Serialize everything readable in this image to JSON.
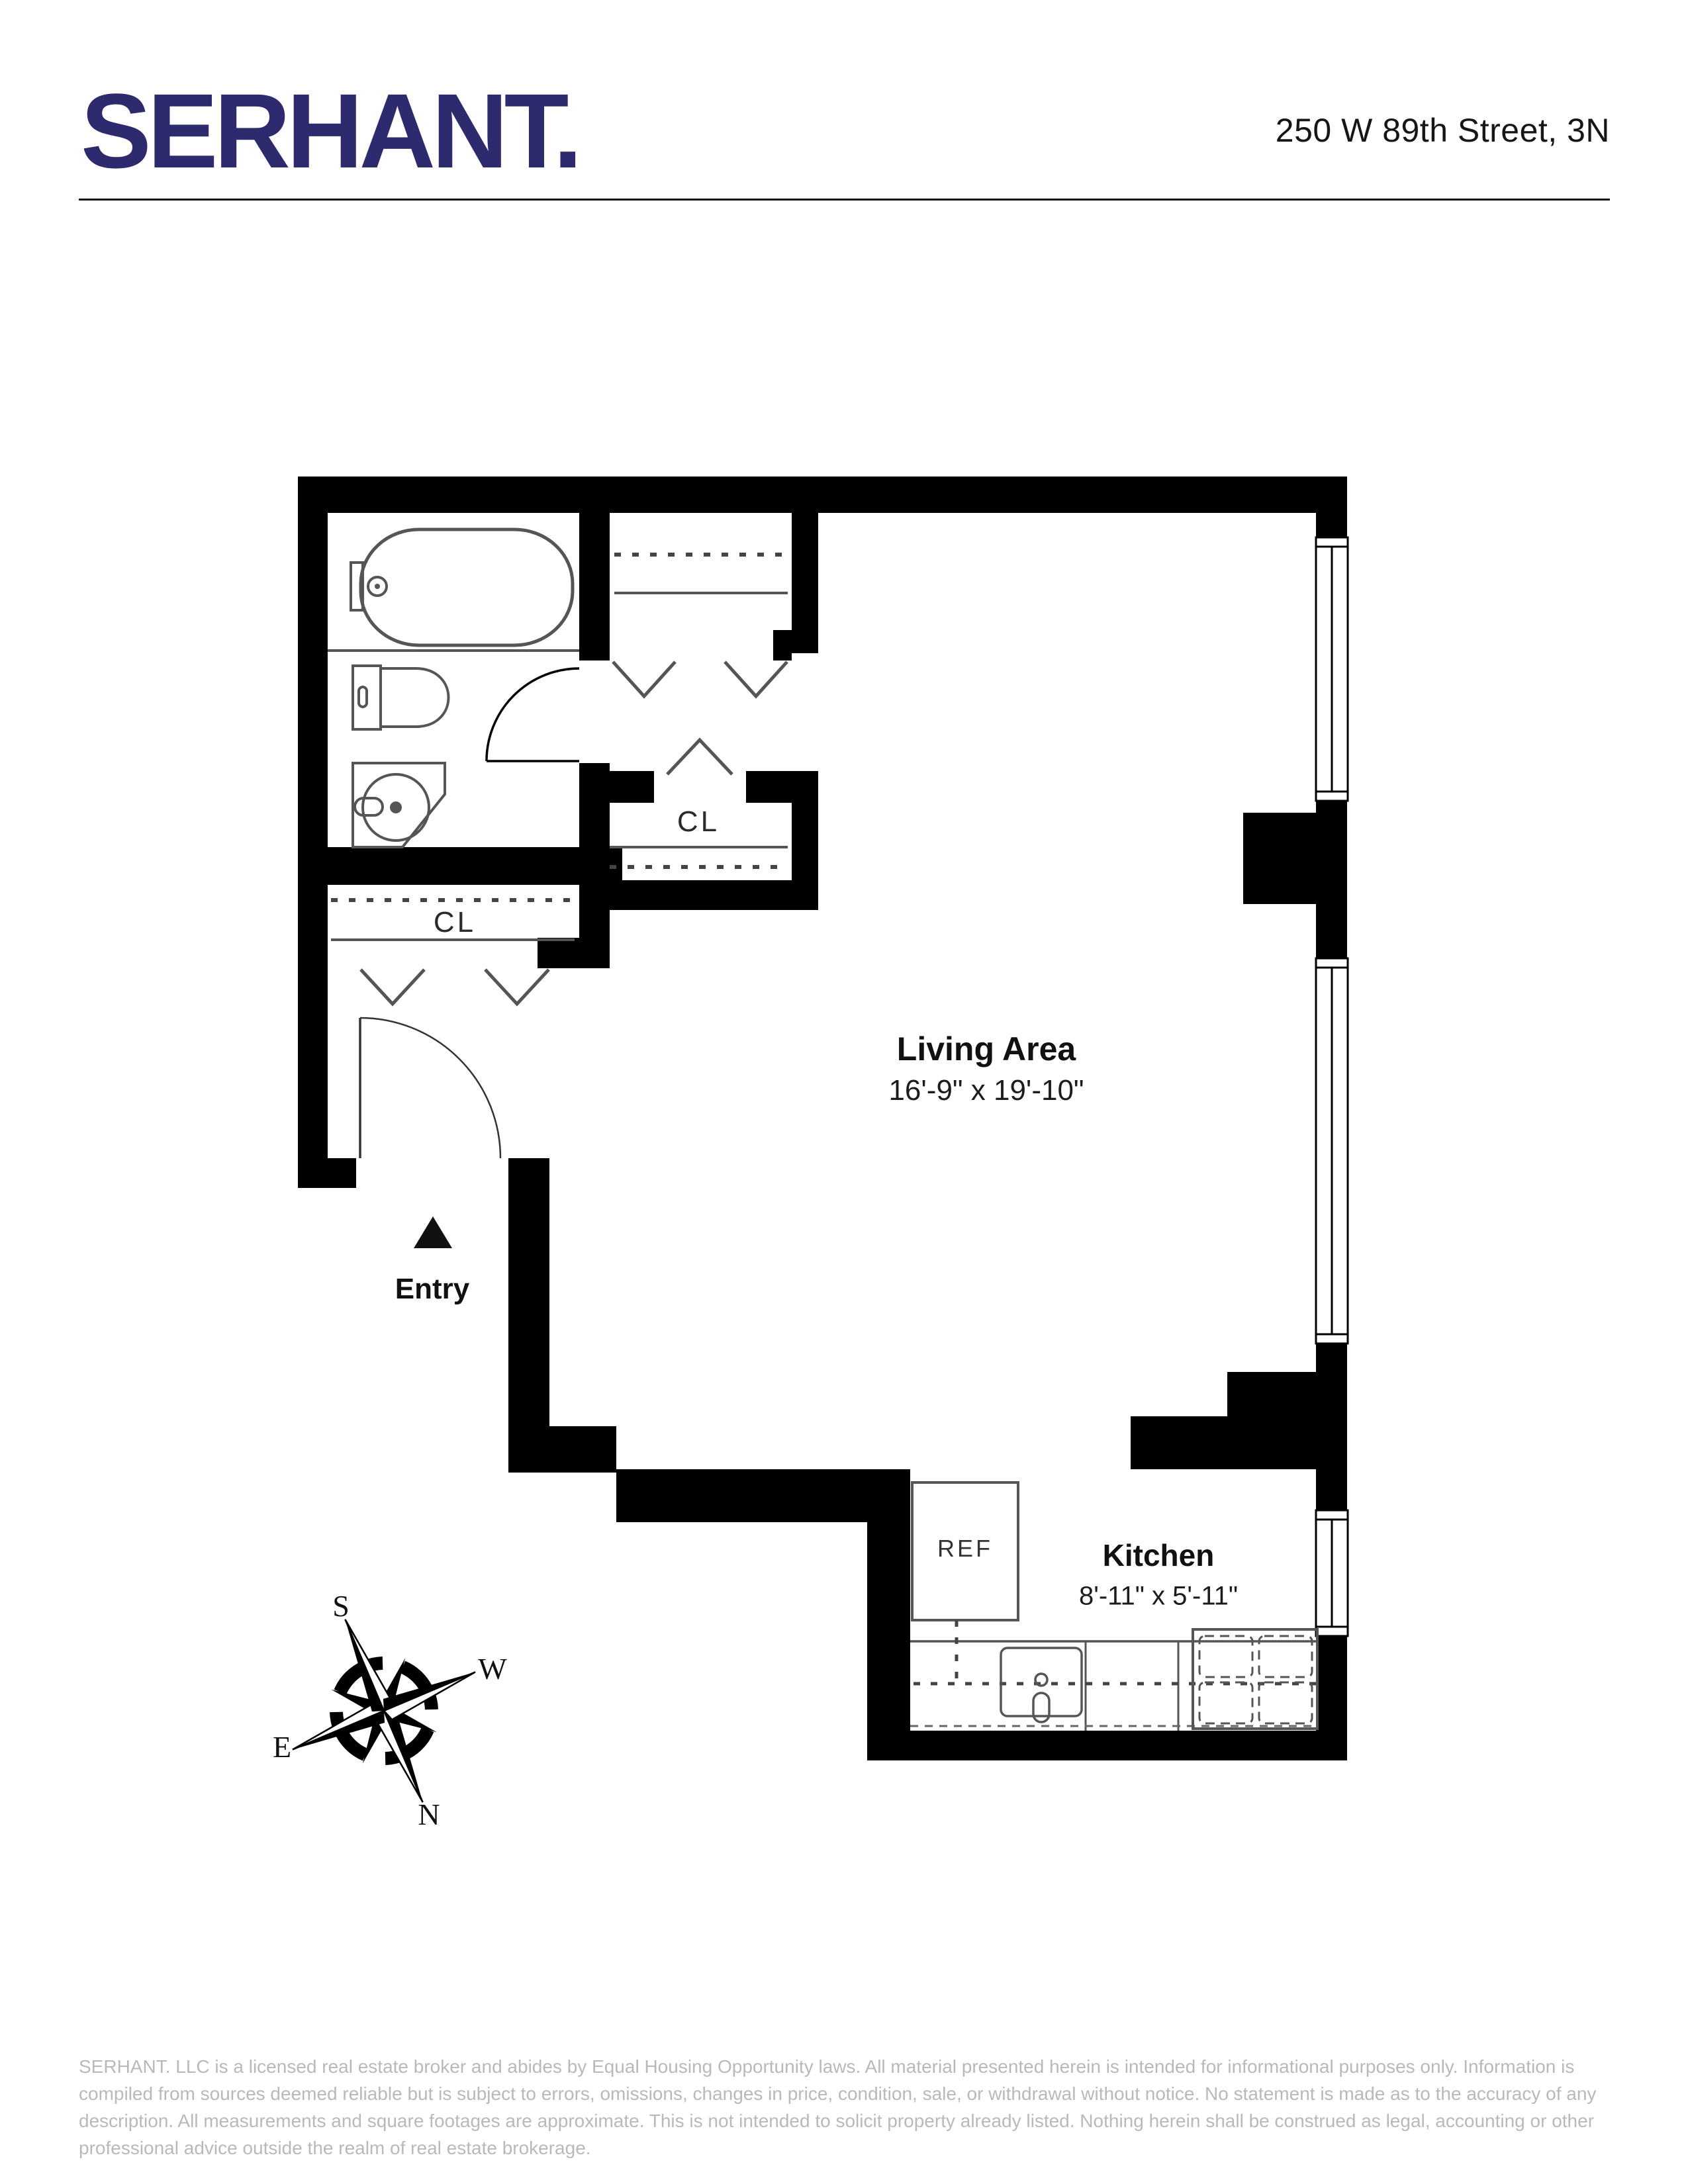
{
  "header": {
    "logo_text": "SERHANT.",
    "address": "250 W 89th Street, 3N"
  },
  "floor_plan": {
    "living_area": {
      "label": "Living Area",
      "dimensions": "16'-9\" x 19'-10\""
    },
    "kitchen": {
      "label": "Kitchen",
      "dimensions": "8'-11\" x 5'-11\""
    },
    "entry": {
      "label": "Entry"
    },
    "closets": {
      "hall": "CL",
      "foyer": "CL"
    },
    "refrigerator_label": "REF",
    "compass": {
      "north": "N",
      "south": "S",
      "east": "E",
      "west": "W"
    }
  },
  "footer": {
    "disclaimer": "SERHANT. LLC is a licensed real estate broker and abides by Equal Housing Opportunity laws. All material presented herein is intended for informational purposes only. Information is compiled from sources deemed reliable but is subject to errors, omissions, changes in price, condition, sale, or withdrawal without notice. No statement is made as to the accuracy of any description. All measurements and square footages are approximate. This is not intended to solicit property already listed. Nothing herein shall be construed as legal, accounting or other professional advice outside the realm of real estate brokerage."
  },
  "colors": {
    "brand_navy": "#2e2a6e",
    "wall_black": "#000000",
    "disclaimer_gray": "#b9b9b9"
  }
}
